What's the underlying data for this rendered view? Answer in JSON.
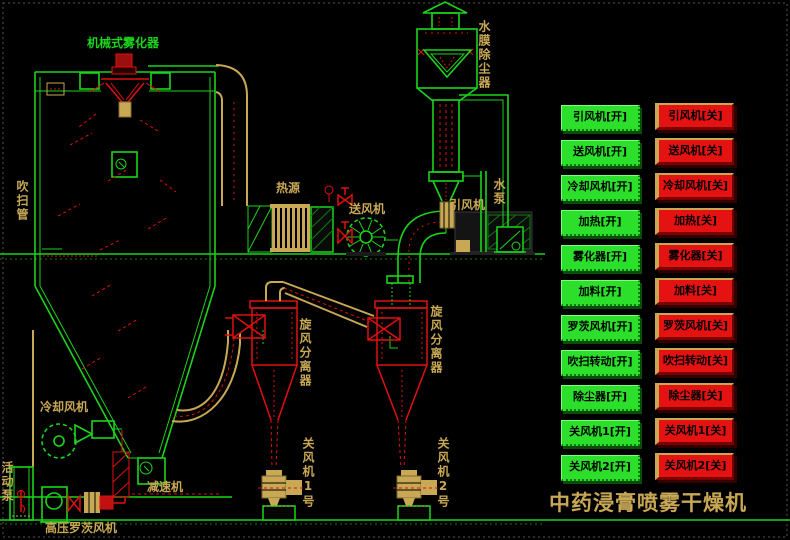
{
  "title": "中药浸膏喷雾干燥机",
  "colors": {
    "background": "#000000",
    "line_green": "#1bd41b",
    "device_red": "#e01010",
    "pipe_tan": "#c9a855",
    "button_on_bg": "#2bdf2b",
    "button_off_bg": "#e51212",
    "button_text": "#000000",
    "title_text": "#c9a855"
  },
  "diagram": {
    "atomizer_label": "机械式雾化器",
    "purge_pipe_label": "吹扫管",
    "heat_source_label": "热源",
    "supply_fan_label": "送风机",
    "induced_fan_label": "引风机",
    "water_pump_label": "水泵",
    "dust_collector_label": "水膜除尘器",
    "cyclone_1_label": "旋风分离器",
    "cyclone_2_label": "旋风分离器",
    "cooling_fan_label": "冷却风机",
    "reducer_label": "减速机",
    "roots_blower_label": "高压罗茨风机",
    "feed_pump_label": "活动泵",
    "rotary_valve_1_label": "关风机1号",
    "rotary_valve_2_label": "关风机2号"
  },
  "controls": {
    "on_buttons": [
      "引风机[开]",
      "送风机[开]",
      "冷却风机[开]",
      "加热[开]",
      "雾化器[开]",
      "加料[开]",
      "罗茨风机[开]",
      "吹扫转动[开]",
      "除尘器[开]",
      "关风机1[开]",
      "关风机2[开]"
    ],
    "off_buttons": [
      "引风机[关]",
      "送风机[关]",
      "冷却风机[关]",
      "加热[关]",
      "雾化器[关]",
      "加料[关]",
      "罗茨风机[关]",
      "吹扫转动[关]",
      "除尘器[关]",
      "关风机1[关]",
      "关风机2[关]"
    ]
  }
}
